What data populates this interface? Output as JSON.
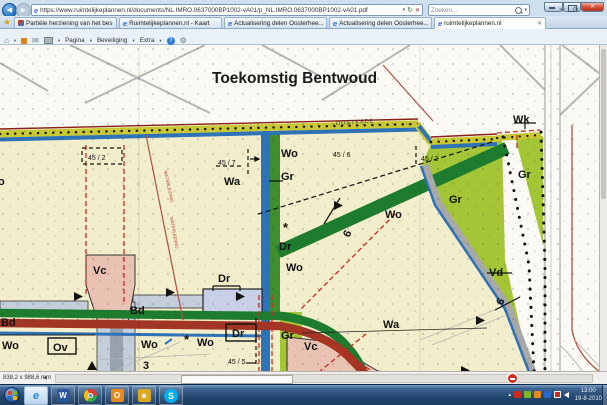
{
  "browser": {
    "url": "https://www.ruimtelijkeplannen.nl/documents/NL.IMRO.0637000BP1002-vA01/p_NL.IMRO.0637000BP1002-vA01.pdf",
    "search_placeholder": "Zoeken...",
    "tabs": [
      {
        "label": "Partiële herziening van het bes..."
      },
      {
        "label": "Ruimtelijkeplannen.nl - Kaart"
      },
      {
        "label": "Actualisering delen Oosterhee..."
      },
      {
        "label": "Actualisering delen Oosterhee..."
      },
      {
        "label": "ruimtelijkeplannen.nl"
      }
    ],
    "menus": [
      "Bestand",
      "Bewerken",
      "Ga naar",
      "Favorieten",
      "Help"
    ],
    "command_bar": {
      "pagina": "Pagina",
      "beveiliging": "Beveiliging",
      "extra": "Extra"
    },
    "icons": {
      "back": "◀",
      "forward": "▶",
      "caret": "▾",
      "refresh": "↻",
      "stop": "✕",
      "home": "⌂",
      "star": "★",
      "gear": "⚙",
      "help": "?",
      "tab_close": "✕",
      "ie_e": "e",
      "mail": "✉",
      "fav_star": "★",
      "hidden_icons": "▴",
      "window_close": "✕"
    }
  },
  "pdf": {
    "status_dimensions": "838,2 x 988,6 mm"
  },
  "map": {
    "colors": {
      "cream": "#f2eecb",
      "light_green": "#a4c636",
      "dark_green": "#1e7c2e",
      "water_blue": "#2e72b8",
      "brick_red": "#a33524",
      "pink": "#eac2b4",
      "lavender": "#c9cfe6",
      "band_gray": "#c4cedb",
      "dash_red": "#cc2a1e",
      "dike_yellow": "#c9c832"
    },
    "labels": {
      "title": "Toekomstig Bentwoud",
      "oostkade": "OOSTKADE",
      "c45_2w": "45 / 2",
      "c45_7": "45 / 7",
      "c45_6": "45 / 6",
      "c45_2e": "45 / 2",
      "c45_5": "45 / 5",
      "wk": "Wk",
      "wo1": "Wo",
      "gr1": "Gr",
      "wa1": "Wa",
      "o_part": "o",
      "gr2": "Gr",
      "gr3": "Gr",
      "wo2": "Wo",
      "ast1": "*",
      "dr1": "Dr",
      "six1": "6",
      "wo3": "Wo",
      "vd": "Vd",
      "six2": "6",
      "vc1": "Vc",
      "dr2": "Dr",
      "bd1": "Bd",
      "bd2": "Bd",
      "wo4": "Wo",
      "ov": "Ov",
      "wo5": "Wo",
      "ast2": "*",
      "wo6": "Wo",
      "dr3": "Dr",
      "gr4": "Gr",
      "three": "3",
      "vc2": "Vc",
      "wa2": "Wa",
      "pipe1": "WATERLEIDING",
      "pipe2": "WATERLEIDING"
    }
  },
  "taskbar": {
    "clock_time": "13:00",
    "clock_date": "19-8-2010",
    "apps": {
      "word": "W",
      "outlook": "O",
      "skype": "S",
      "ie": "e",
      "gold_star": "★"
    }
  }
}
